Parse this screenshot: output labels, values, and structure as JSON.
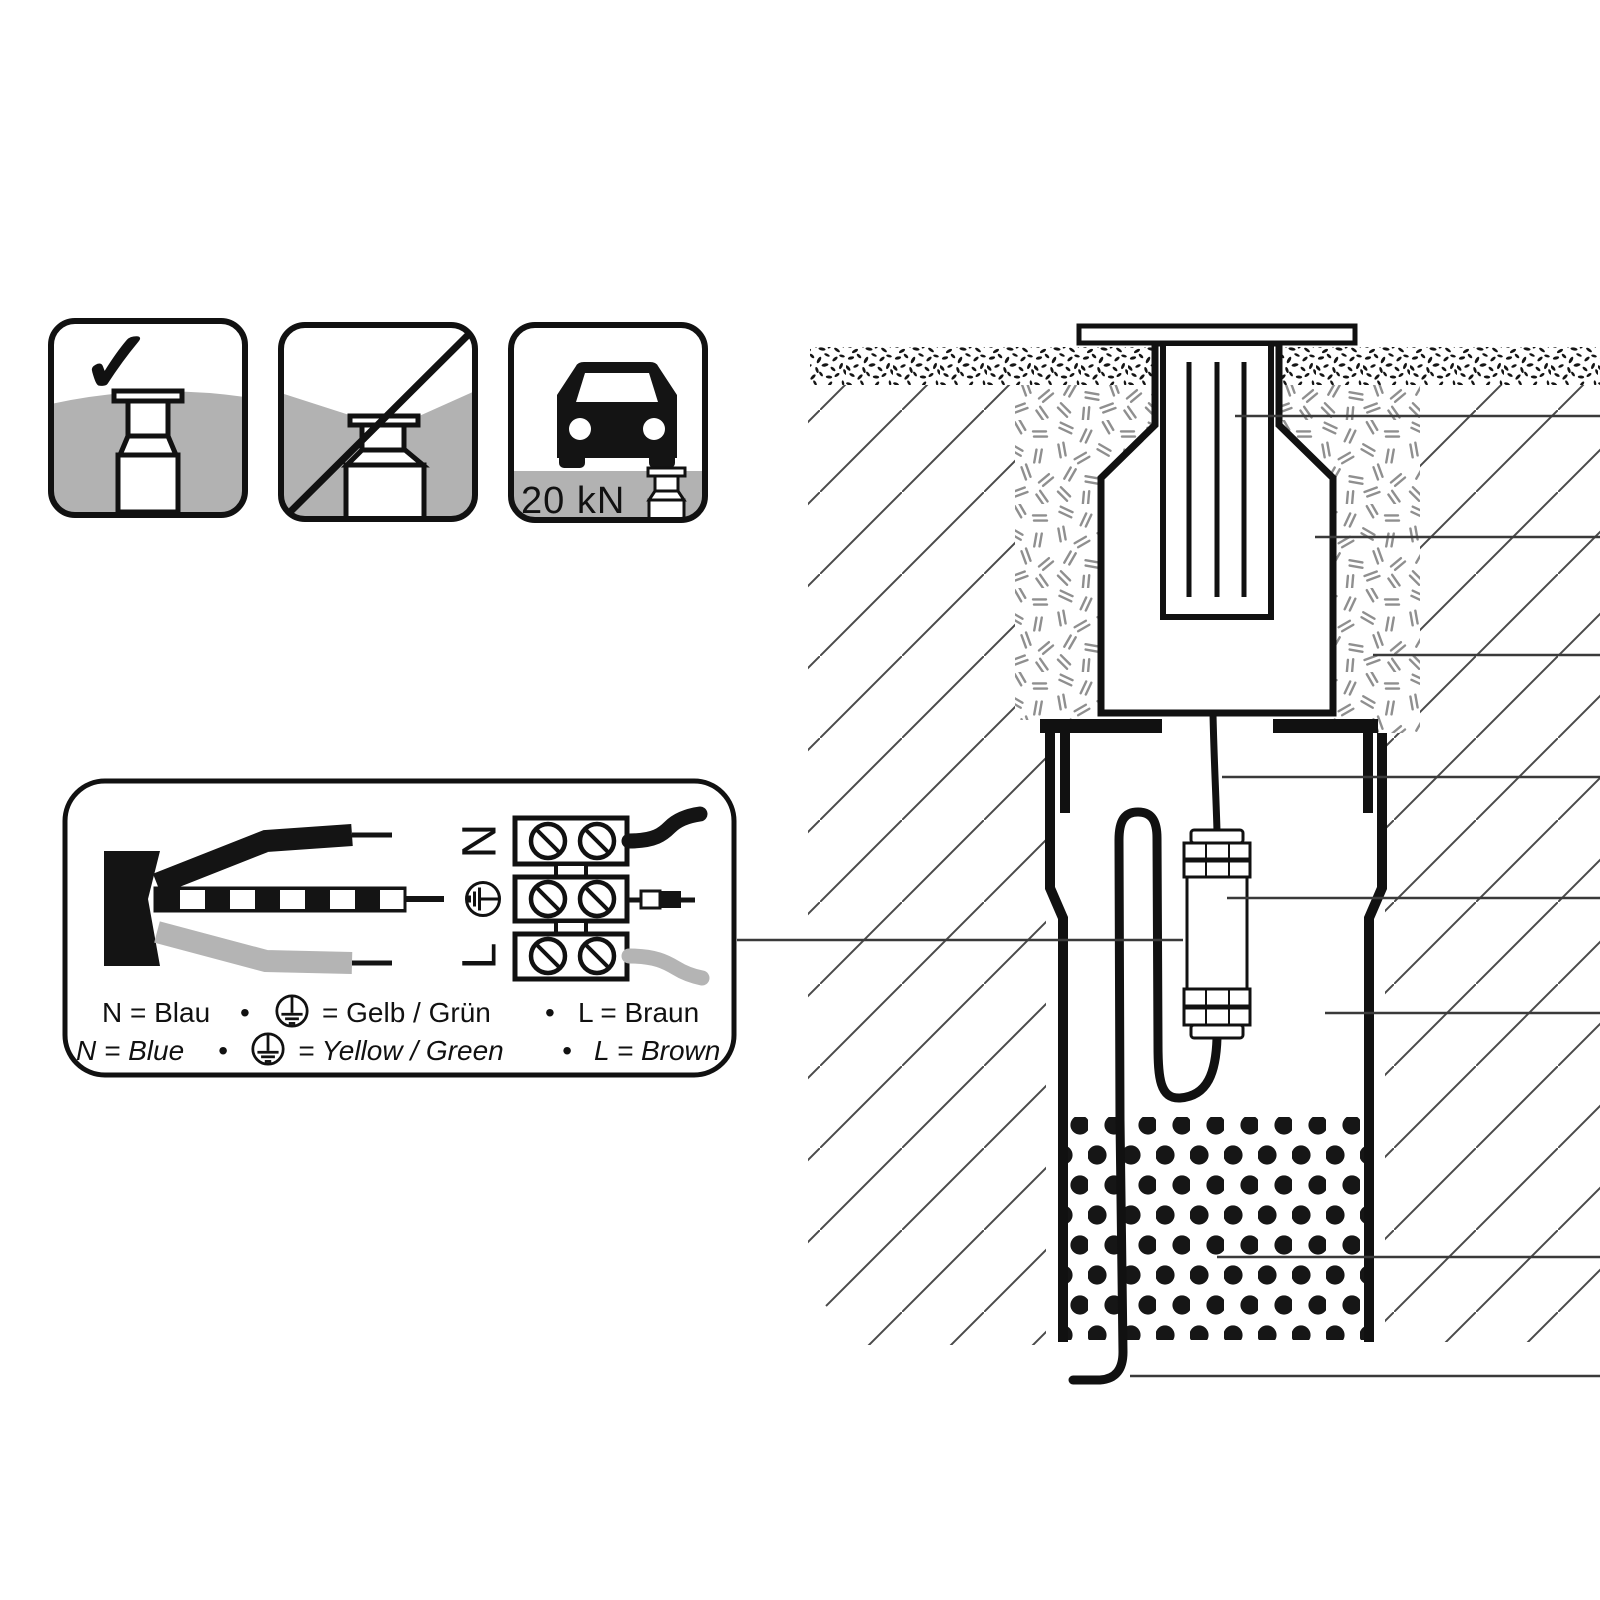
{
  "icons_row": {
    "allowed": {
      "icon": "check-icon",
      "check_glyph": "✓"
    },
    "not_allowed": {
      "icon": "prohibition-slash-icon"
    },
    "drive_over": {
      "icon": "car-icon",
      "load_label": "20 kN"
    }
  },
  "wiring_box": {
    "terminals": [
      {
        "label": "N"
      },
      {
        "label": "PE",
        "icon": "earth-icon"
      },
      {
        "label": "L"
      }
    ],
    "legend": {
      "bullet": "•",
      "de": {
        "neutral": "N = Blau",
        "earth_equals": "= Gelb / Grün",
        "line": "L = Braun"
      },
      "en": {
        "neutral": "N = Blue",
        "earth_equals": "= Yellow / Green",
        "line": "L = Brown"
      }
    }
  },
  "colors": {
    "ground_gray": "#b2b2b2",
    "wire_gray": "#b4b4b4",
    "ink": "#111111",
    "leader_line": "#3a3a3a",
    "hatch_line": "#4a4a4a",
    "bedding_dash": "#8f8f8f"
  }
}
